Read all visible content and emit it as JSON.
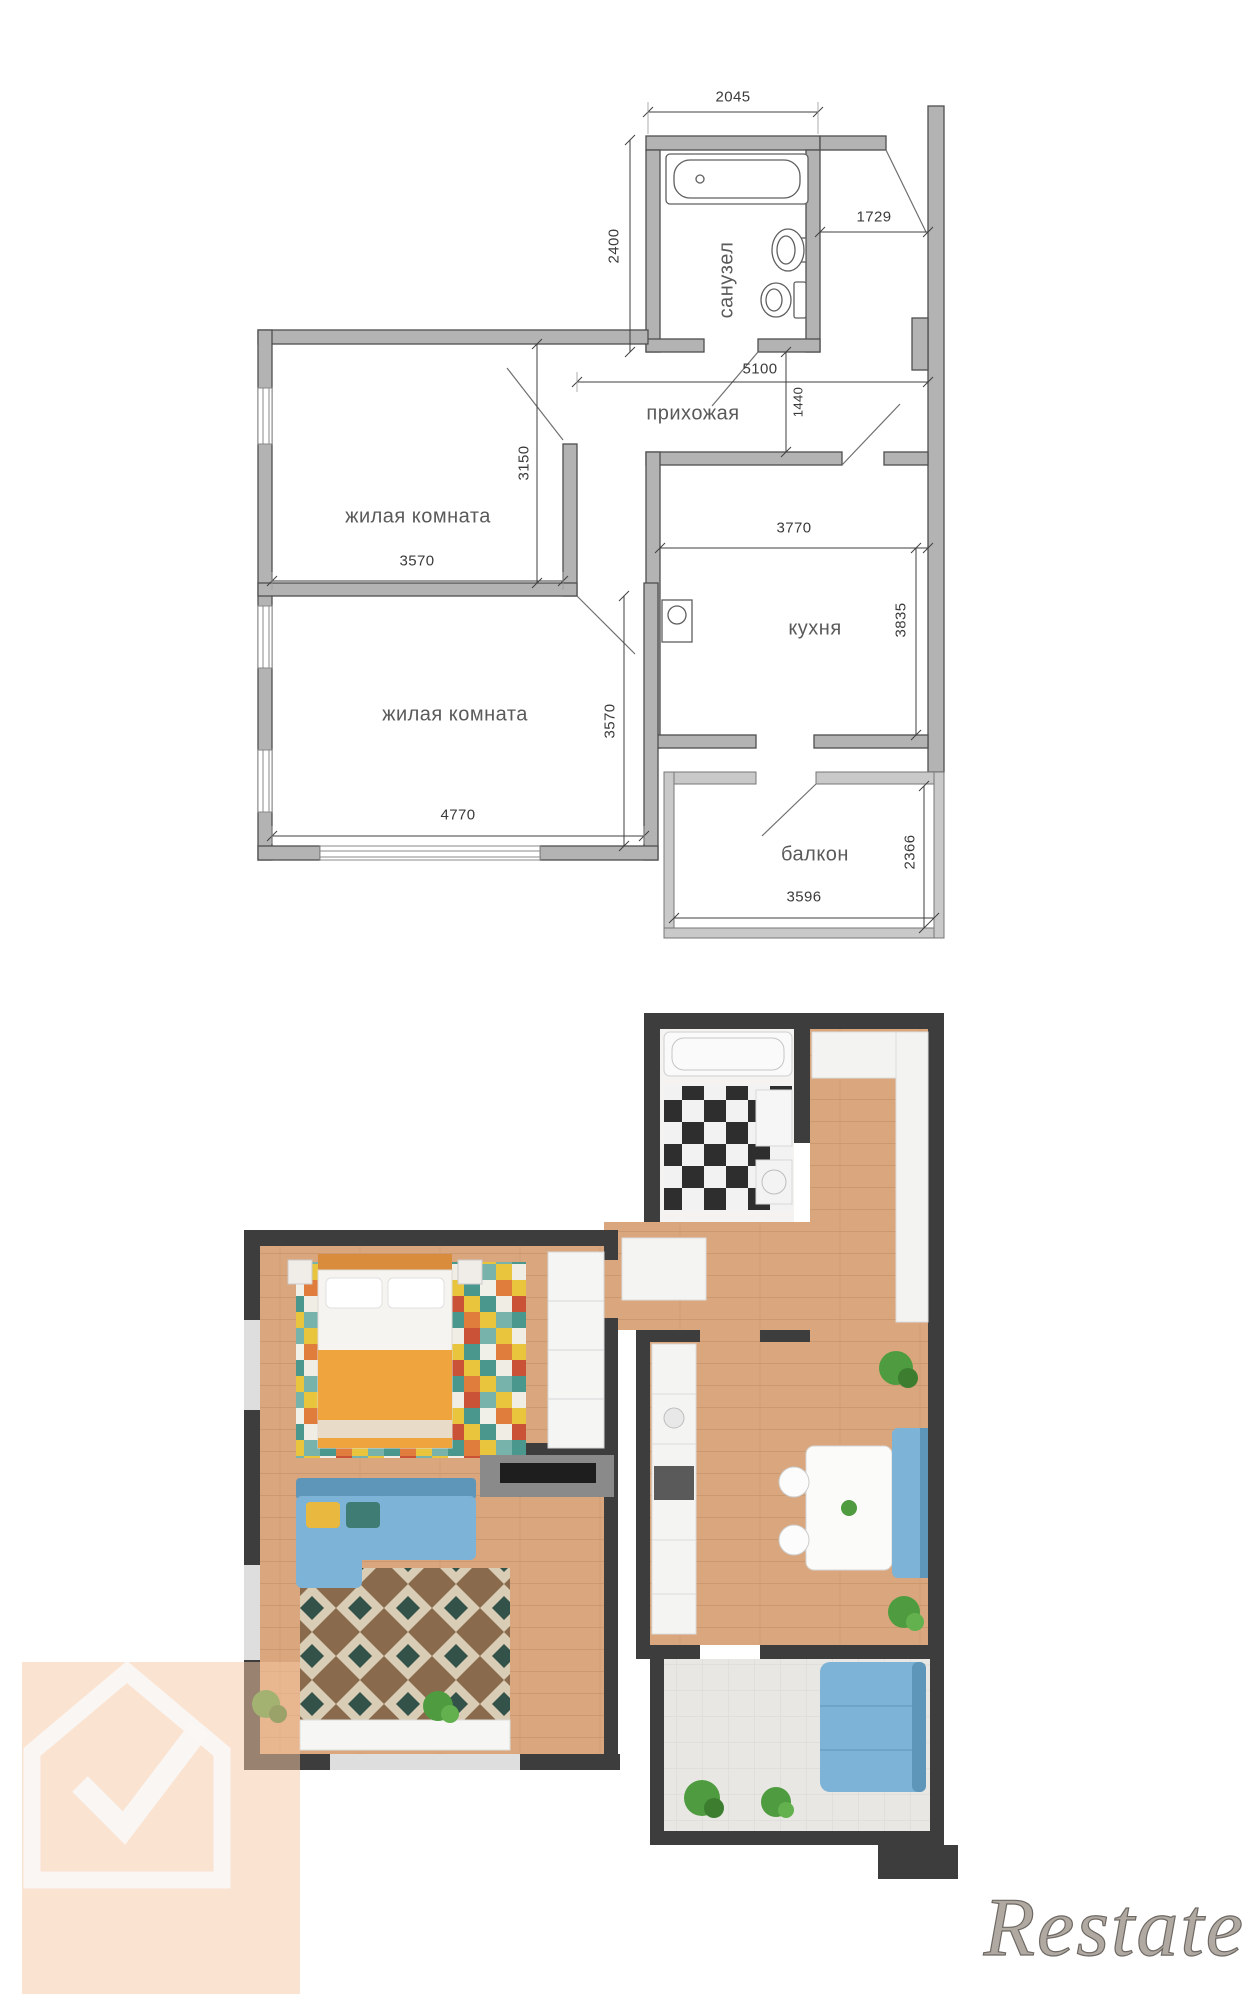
{
  "watermark": {
    "brand": "Restate"
  },
  "plan": {
    "rooms": {
      "bathroom": "санузел",
      "hallway": "прихожая",
      "room1": "жилая комната",
      "room2": "жилая комната",
      "kitchen": "кухня",
      "balcony": "балкон"
    },
    "dims": {
      "bath_w": "2045",
      "bath_h": "2400",
      "entry_w": "1729",
      "hall_w": "5100",
      "hall_h": "1440",
      "room1_w": "3570",
      "room1_h": "3150",
      "room2_w": "4770",
      "room2_h": "3570",
      "kitchen_w": "3770",
      "kitchen_h": "3835",
      "balcony_w": "3596",
      "balcony_h": "2366"
    },
    "colors": {
      "tech_wall": "#b3b3b3",
      "render_wall": "#3d3d3d",
      "floor_wood": "#d9a67d",
      "sofa_blue": "#7db3d6",
      "blanket_orange": "#f0a43e",
      "plant_green": "#4e9c3f",
      "watermark_peach": "#f7c7a3"
    }
  }
}
